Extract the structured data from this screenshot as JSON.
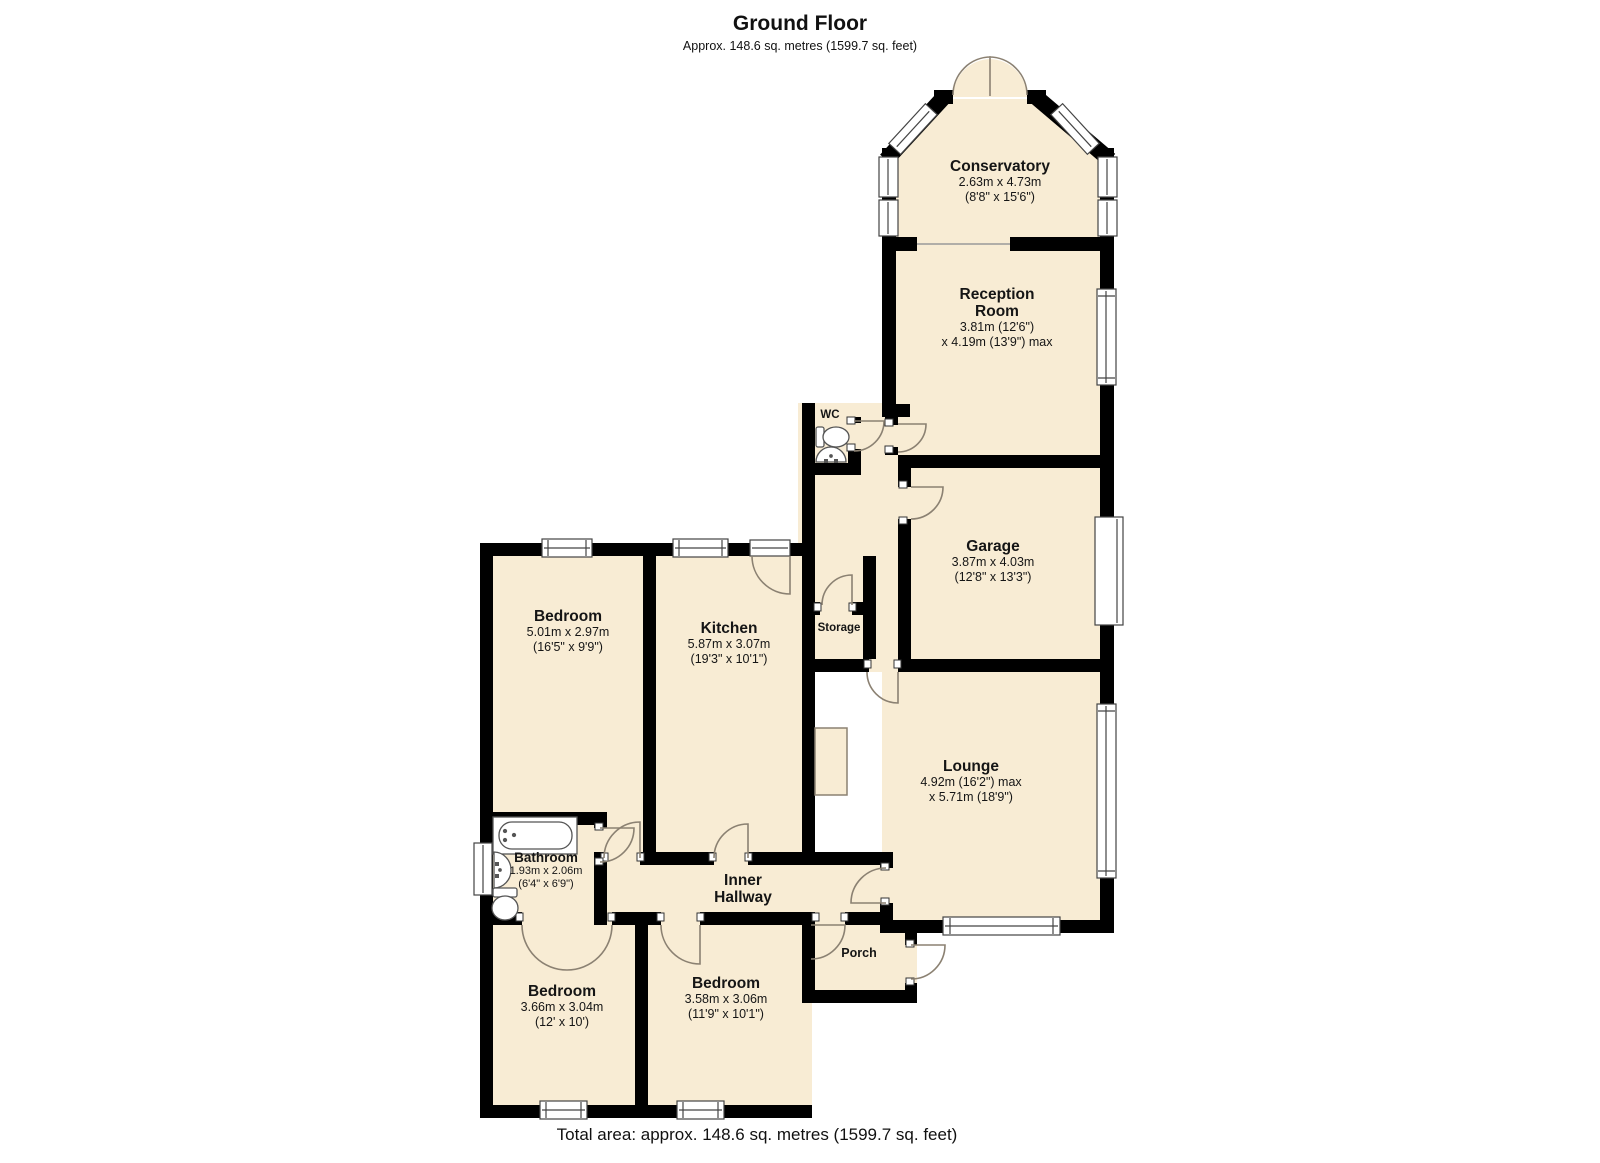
{
  "header": {
    "title": "Ground Floor",
    "subtitle": "Approx. 148.6 sq. metres (1599.7 sq. feet)"
  },
  "footer": {
    "total_area": "Total area: approx. 148.6 sq. metres (1599.7 sq. feet)"
  },
  "colors": {
    "floor_fill": "#F8ECD4",
    "wall": "#000000",
    "door_arc": "#8B8172",
    "window_outline": "#444444"
  },
  "symbols": [
    "window",
    "door-swing",
    "double-door-swing",
    "toilet",
    "sink",
    "bathtub",
    "garage-door",
    "chimney-breast"
  ],
  "rooms": {
    "conservatory": {
      "name": "Conservatory",
      "dim_m": "2.63m x 4.73m",
      "dim_ft": "(8'8\" x 15'6\")"
    },
    "reception": {
      "name": "Reception",
      "name2": "Room",
      "dim1": "3.81m (12'6\")",
      "dim2": "x 4.19m (13'9\") max"
    },
    "wc": {
      "name": "WC"
    },
    "garage": {
      "name": "Garage",
      "dim_m": "3.87m x 4.03m",
      "dim_ft": "(12'8\" x 13'3\")"
    },
    "bedroom_left": {
      "name": "Bedroom",
      "dim_m": "5.01m x 2.97m",
      "dim_ft": "(16'5\" x 9'9\")"
    },
    "kitchen": {
      "name": "Kitchen",
      "dim_m": "5.87m x 3.07m",
      "dim_ft": "(19'3\" x 10'1\")"
    },
    "storage": {
      "name": "Storage"
    },
    "lounge": {
      "name": "Lounge",
      "dim1": "4.92m (16'2\") max",
      "dim2": "x 5.71m (18'9\")"
    },
    "bathroom": {
      "name": "Bathroom",
      "dim_m": "1.93m x 2.06m",
      "dim_ft": "(6'4\" x 6'9\")"
    },
    "inner_hallway": {
      "name": "Inner",
      "name2": "Hallway"
    },
    "porch": {
      "name": "Porch"
    },
    "bedroom_bottom_left": {
      "name": "Bedroom",
      "dim_m": "3.66m x 3.04m",
      "dim_ft": "(12' x 10')"
    },
    "bedroom_bottom_middle": {
      "name": "Bedroom",
      "dim_m": "3.58m x 3.06m",
      "dim_ft": "(11'9\" x 10'1\")"
    }
  }
}
